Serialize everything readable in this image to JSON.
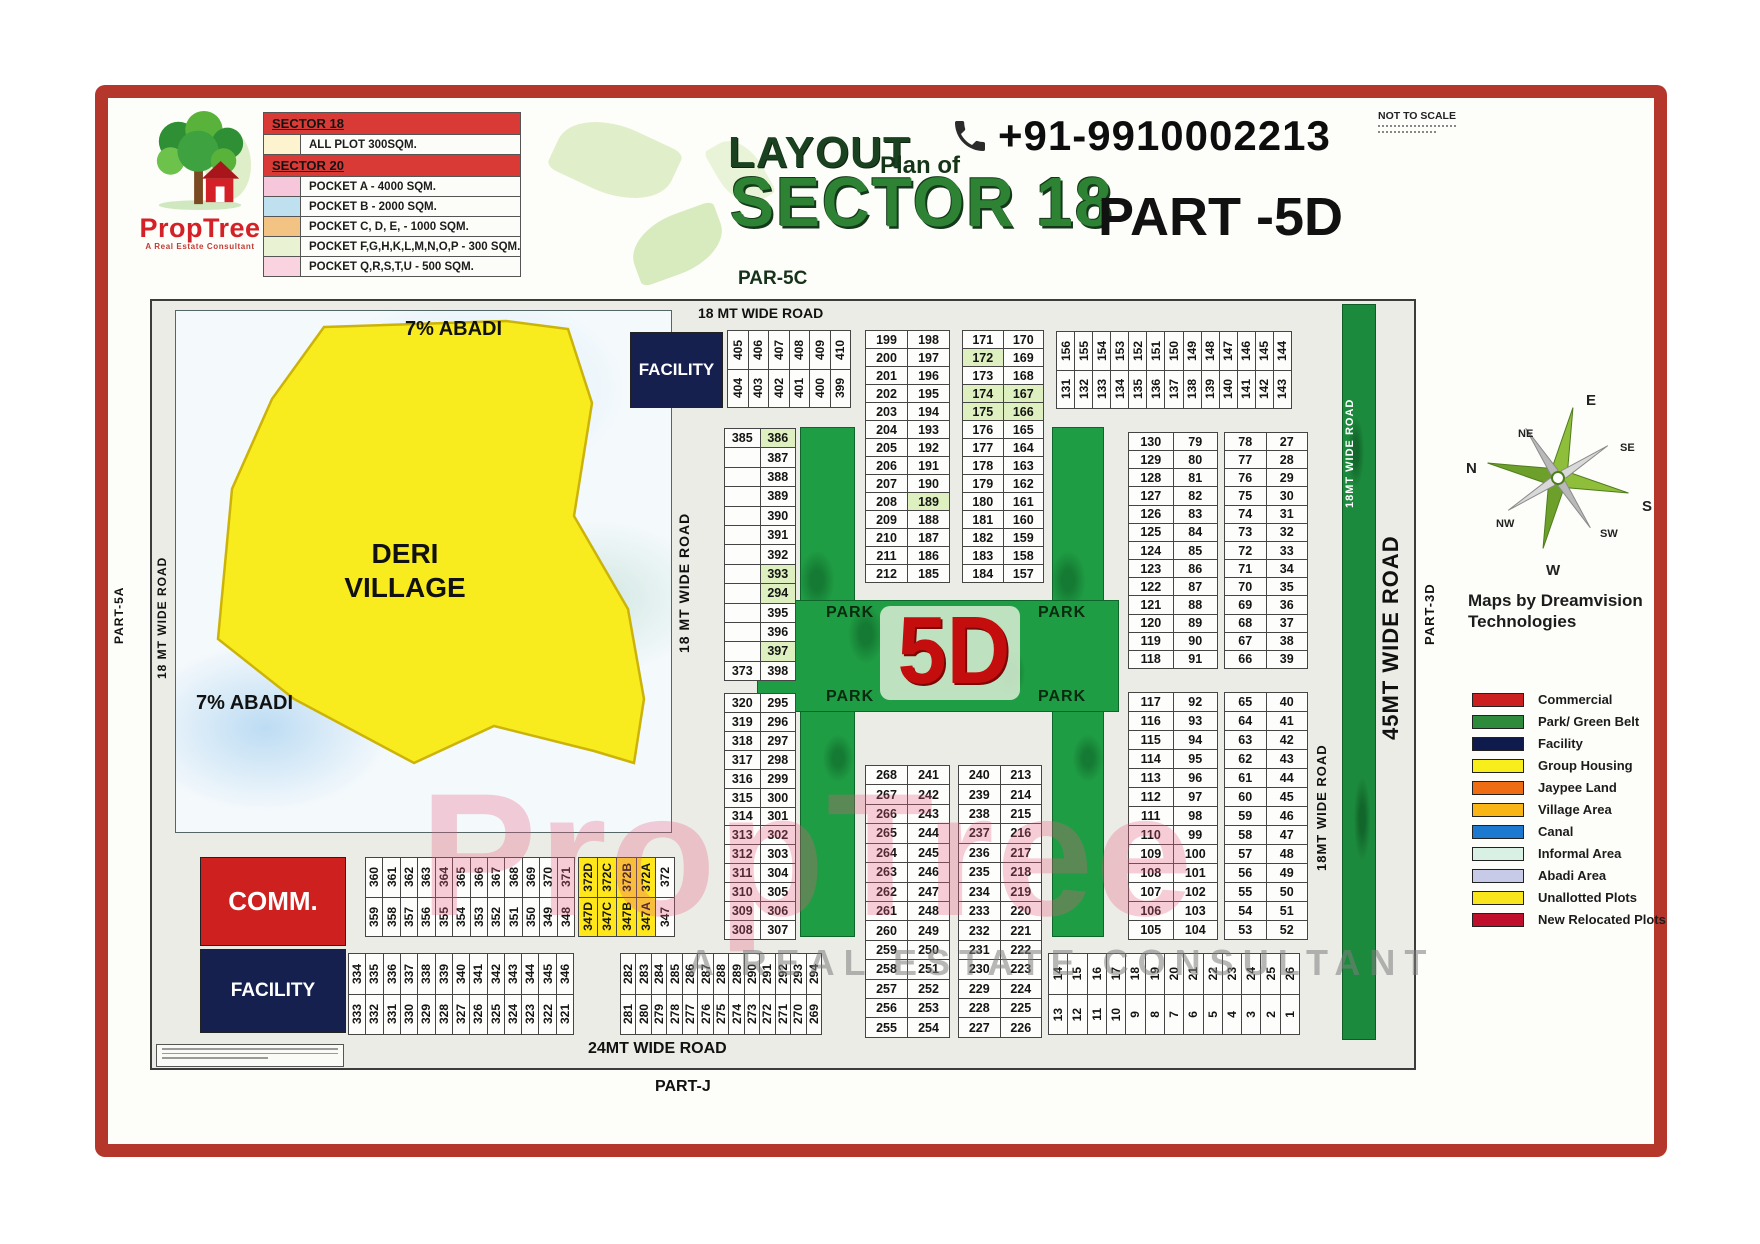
{
  "brand": {
    "name": "PropTree",
    "tagline": "A Real Estate Consultant"
  },
  "header": {
    "title_layout": "LAYOUT",
    "title_plan_of": "Plan of",
    "title_sector": "SECTOR 18",
    "title_part": "PART -5D",
    "phone": "+91-9910002213",
    "not_to_scale": "NOT TO SCALE"
  },
  "plot_table": {
    "rows": [
      {
        "type": "header",
        "color": "#d93a35",
        "label": "SECTOR 18"
      },
      {
        "type": "item",
        "color": "#fdf3cf",
        "label": "ALL PLOT  300SQM."
      },
      {
        "type": "header",
        "color": "#d93a35",
        "label": "SECTOR 20"
      },
      {
        "type": "item",
        "color": "#f6c6da",
        "label": "POCKET A   -  4000 SQM."
      },
      {
        "type": "item",
        "color": "#bfe0ef",
        "label": "POCKET B   -  2000 SQM."
      },
      {
        "type": "item",
        "color": "#f2c383",
        "label": "POCKET C, D, E, - 1000 SQM."
      },
      {
        "type": "item",
        "color": "#e9f3d4",
        "label": "POCKET  F,G,H,K,L,M,N,O,P  -  300 SQM."
      },
      {
        "type": "item",
        "color": "#f9d3e0",
        "label": "POCKET Q,R,S,T,U   -  500 SQM."
      }
    ]
  },
  "roads": {
    "top_18": "18 MT WIDE ROAD",
    "left_18": "18 MT WIDE ROAD",
    "inner_18": "18 MT WIDE ROAD",
    "bottom_24": "24MT WIDE ROAD",
    "right_45": "45MT WIDE ROAD",
    "right_18_upper": "18MT WIDE ROAD",
    "right_18_lower": "18MT WIDE ROAD",
    "part_5a": "PART-5A",
    "par_5c": "PAR-5C",
    "part_j": "PART-J",
    "part_3d": "PART-3D"
  },
  "village": {
    "name_line1": "DERI",
    "name_line2": "VILLAGE",
    "abadi_top": "7% ABADI",
    "abadi_bottom": "7% ABADI"
  },
  "blocks": {
    "facility_top": "FACILITY",
    "comm": "COMM.",
    "facility_bottom": "FACILITY",
    "park": "PARK",
    "sector_5d": "5D"
  },
  "compass": {
    "n": "N",
    "ne": "NE",
    "e": "E",
    "se": "SE",
    "s": "S",
    "sw": "SW",
    "w": "W",
    "nw": "NW"
  },
  "credits": {
    "maps_by_line1": "Maps by Dreamvision",
    "maps_by_line2": "Technologies"
  },
  "map_legend": [
    {
      "label": "Commercial",
      "color": "#cc1f1f"
    },
    {
      "label": "Park/ Green Belt",
      "color": "#2e8b3c"
    },
    {
      "label": "Facility",
      "color": "#101b4d"
    },
    {
      "label": "Group Housing",
      "color": "#f8ee1b"
    },
    {
      "label": "Jaypee Land",
      "color": "#ef6d12"
    },
    {
      "label": "Village Area",
      "color": "#f9b515"
    },
    {
      "label": "Canal",
      "color": "#1c79d0"
    },
    {
      "label": "Informal Area",
      "color": "#d9f0e4"
    },
    {
      "label": "Abadi Area",
      "color": "#c7cbe8"
    },
    {
      "label": "Unallotted Plots",
      "color": "#f9e51c"
    },
    {
      "label": "New Relocated Plots",
      "color": "#c00f2d"
    }
  ],
  "watermark": {
    "name": "PropTree",
    "subtitle": "A REAL ESTATE CONSULTANT"
  },
  "highlight_plots": [
    "386",
    "393",
    "294",
    "397",
    "189",
    "172",
    "174",
    "175",
    "166",
    "167"
  ],
  "grids": {
    "s405": {
      "top": [
        "405",
        "406",
        "407",
        "408",
        "409",
        "410"
      ],
      "bottom": [
        "404",
        "403",
        "402",
        "401",
        "400",
        "399"
      ]
    },
    "g199": [
      [
        "199",
        "198"
      ],
      [
        "200",
        "197"
      ],
      [
        "201",
        "196"
      ],
      [
        "202",
        "195"
      ],
      [
        "203",
        "194"
      ],
      [
        "204",
        "193"
      ],
      [
        "205",
        "192"
      ],
      [
        "206",
        "191"
      ],
      [
        "207",
        "190"
      ],
      [
        "208",
        "189"
      ],
      [
        "209",
        "188"
      ],
      [
        "210",
        "187"
      ],
      [
        "211",
        "186"
      ],
      [
        "212",
        "185"
      ]
    ],
    "g171": [
      [
        "171",
        "170"
      ],
      [
        "172",
        "169"
      ],
      [
        "173",
        "168"
      ],
      [
        "174",
        "167"
      ],
      [
        "175",
        "166"
      ],
      [
        "176",
        "165"
      ],
      [
        "177",
        "164"
      ],
      [
        "178",
        "163"
      ],
      [
        "179",
        "162"
      ],
      [
        "180",
        "161"
      ],
      [
        "181",
        "160"
      ],
      [
        "182",
        "159"
      ],
      [
        "183",
        "158"
      ],
      [
        "184",
        "157"
      ]
    ],
    "s131": {
      "top": [
        "156",
        "155",
        "154",
        "153",
        "152",
        "151",
        "150",
        "149",
        "148",
        "147",
        "146",
        "145",
        "144"
      ],
      "bottom": [
        "131",
        "132",
        "133",
        "134",
        "135",
        "136",
        "137",
        "138",
        "139",
        "140",
        "141",
        "142",
        "143"
      ]
    },
    "g385": [
      [
        "385",
        "386"
      ],
      [
        "",
        "387"
      ],
      [
        "",
        "388"
      ],
      [
        "",
        "389"
      ],
      [
        "",
        "390"
      ],
      [
        "",
        "391"
      ],
      [
        "",
        "392"
      ],
      [
        "",
        "393"
      ],
      [
        "",
        "294"
      ],
      [
        "",
        "395"
      ],
      [
        "",
        "396"
      ],
      [
        "",
        "397"
      ],
      [
        "373",
        "398"
      ]
    ],
    "g320": [
      [
        "320",
        "295"
      ],
      [
        "319",
        "296"
      ],
      [
        "318",
        "297"
      ],
      [
        "317",
        "298"
      ],
      [
        "316",
        "299"
      ],
      [
        "315",
        "300"
      ],
      [
        "314",
        "301"
      ],
      [
        "313",
        "302"
      ],
      [
        "312",
        "303"
      ],
      [
        "311",
        "304"
      ],
      [
        "310",
        "305"
      ],
      [
        "309",
        "306"
      ],
      [
        "308",
        "307"
      ]
    ],
    "g130": [
      [
        "130",
        "79"
      ],
      [
        "129",
        "80"
      ],
      [
        "128",
        "81"
      ],
      [
        "127",
        "82"
      ],
      [
        "126",
        "83"
      ],
      [
        "125",
        "84"
      ],
      [
        "124",
        "85"
      ],
      [
        "123",
        "86"
      ],
      [
        "122",
        "87"
      ],
      [
        "121",
        "88"
      ],
      [
        "120",
        "89"
      ],
      [
        "119",
        "90"
      ],
      [
        "118",
        "91"
      ]
    ],
    "g78": [
      [
        "78",
        "27"
      ],
      [
        "77",
        "28"
      ],
      [
        "76",
        "29"
      ],
      [
        "75",
        "30"
      ],
      [
        "74",
        "31"
      ],
      [
        "73",
        "32"
      ],
      [
        "72",
        "33"
      ],
      [
        "71",
        "34"
      ],
      [
        "70",
        "35"
      ],
      [
        "69",
        "36"
      ],
      [
        "68",
        "37"
      ],
      [
        "67",
        "38"
      ],
      [
        "66",
        "39"
      ]
    ],
    "g117": [
      [
        "117",
        "92"
      ],
      [
        "116",
        "93"
      ],
      [
        "115",
        "94"
      ],
      [
        "114",
        "95"
      ],
      [
        "113",
        "96"
      ],
      [
        "112",
        "97"
      ],
      [
        "111",
        "98"
      ],
      [
        "110",
        "99"
      ],
      [
        "109",
        "100"
      ],
      [
        "108",
        "101"
      ],
      [
        "107",
        "102"
      ],
      [
        "106",
        "103"
      ],
      [
        "105",
        "104"
      ]
    ],
    "g65": [
      [
        "65",
        "40"
      ],
      [
        "64",
        "41"
      ],
      [
        "63",
        "42"
      ],
      [
        "62",
        "43"
      ],
      [
        "61",
        "44"
      ],
      [
        "60",
        "45"
      ],
      [
        "59",
        "46"
      ],
      [
        "58",
        "47"
      ],
      [
        "57",
        "48"
      ],
      [
        "56",
        "49"
      ],
      [
        "55",
        "50"
      ],
      [
        "54",
        "51"
      ],
      [
        "53",
        "52"
      ]
    ],
    "g268": [
      [
        "268",
        "241"
      ],
      [
        "267",
        "242"
      ],
      [
        "266",
        "243"
      ],
      [
        "265",
        "244"
      ],
      [
        "264",
        "245"
      ],
      [
        "263",
        "246"
      ],
      [
        "262",
        "247"
      ],
      [
        "261",
        "248"
      ],
      [
        "260",
        "249"
      ],
      [
        "259",
        "250"
      ],
      [
        "258",
        "251"
      ],
      [
        "257",
        "252"
      ],
      [
        "256",
        "253"
      ],
      [
        "255",
        "254"
      ]
    ],
    "g240": [
      [
        "240",
        "213"
      ],
      [
        "239",
        "214"
      ],
      [
        "238",
        "215"
      ],
      [
        "237",
        "216"
      ],
      [
        "236",
        "217"
      ],
      [
        "235",
        "218"
      ],
      [
        "234",
        "219"
      ],
      [
        "233",
        "220"
      ],
      [
        "232",
        "221"
      ],
      [
        "231",
        "222"
      ],
      [
        "230",
        "223"
      ],
      [
        "229",
        "224"
      ],
      [
        "228",
        "225"
      ],
      [
        "227",
        "226"
      ]
    ],
    "s360": {
      "top": [
        "360",
        "361",
        "362",
        "363",
        "364",
        "365",
        "366",
        "367",
        "368",
        "369",
        "370",
        "371"
      ],
      "bottom": [
        "359",
        "358",
        "357",
        "356",
        "355",
        "354",
        "353",
        "352",
        "351",
        "350",
        "349",
        "348"
      ]
    },
    "s372": {
      "top": [
        "372D",
        "372C",
        "372B",
        "372A",
        "372"
      ],
      "bottom": [
        "347D",
        "347C",
        "347B",
        "347A",
        "347"
      ],
      "yellow": [
        true,
        true,
        true,
        true,
        false
      ]
    },
    "s334": {
      "top": [
        "334",
        "335",
        "336",
        "337",
        "338",
        "339",
        "340",
        "341",
        "342",
        "343",
        "344",
        "345",
        "346"
      ],
      "bottom": [
        "333",
        "332",
        "331",
        "330",
        "329",
        "328",
        "327",
        "326",
        "325",
        "324",
        "323",
        "322",
        "321"
      ]
    },
    "s282": {
      "top": [
        "282",
        "283",
        "284",
        "285",
        "286",
        "287",
        "288",
        "289",
        "290",
        "291",
        "292",
        "293",
        "294"
      ],
      "bottom": [
        "281",
        "280",
        "279",
        "278",
        "277",
        "276",
        "275",
        "274",
        "273",
        "272",
        "271",
        "270",
        "269"
      ]
    },
    "s126": {
      "top": [
        "14",
        "15",
        "16",
        "17",
        "18",
        "19",
        "20",
        "21",
        "22",
        "23",
        "24",
        "25",
        "26"
      ],
      "bottom": [
        "13",
        "12",
        "11",
        "10",
        "9",
        "8",
        "7",
        "6",
        "5",
        "4",
        "3",
        "2",
        "1"
      ]
    }
  }
}
